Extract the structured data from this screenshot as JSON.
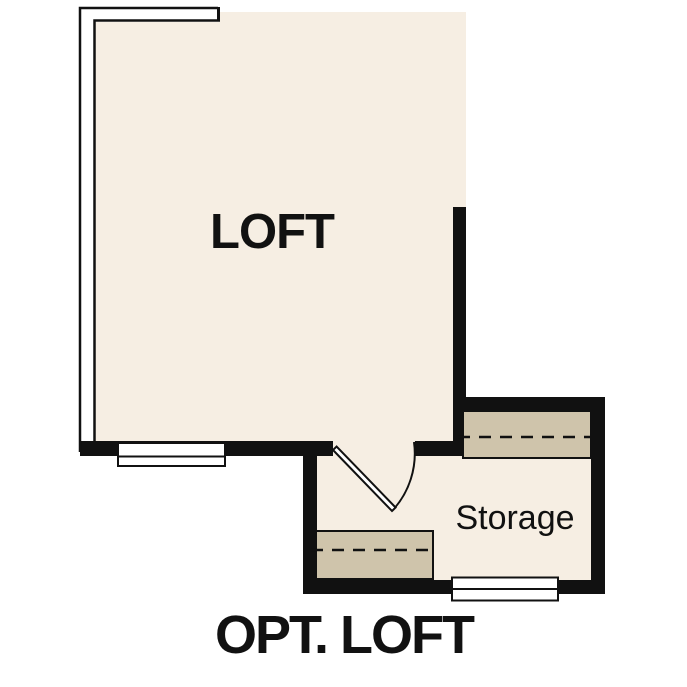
{
  "plan": {
    "title": "OPT. LOFT"
  },
  "rooms": {
    "loft": {
      "label": "LOFT"
    },
    "storage": {
      "label": "Storage"
    }
  },
  "colors": {
    "ink": "#111111",
    "floor": "#f6eee3",
    "shelf": "#cfc4ab",
    "background": "#ffffff"
  }
}
